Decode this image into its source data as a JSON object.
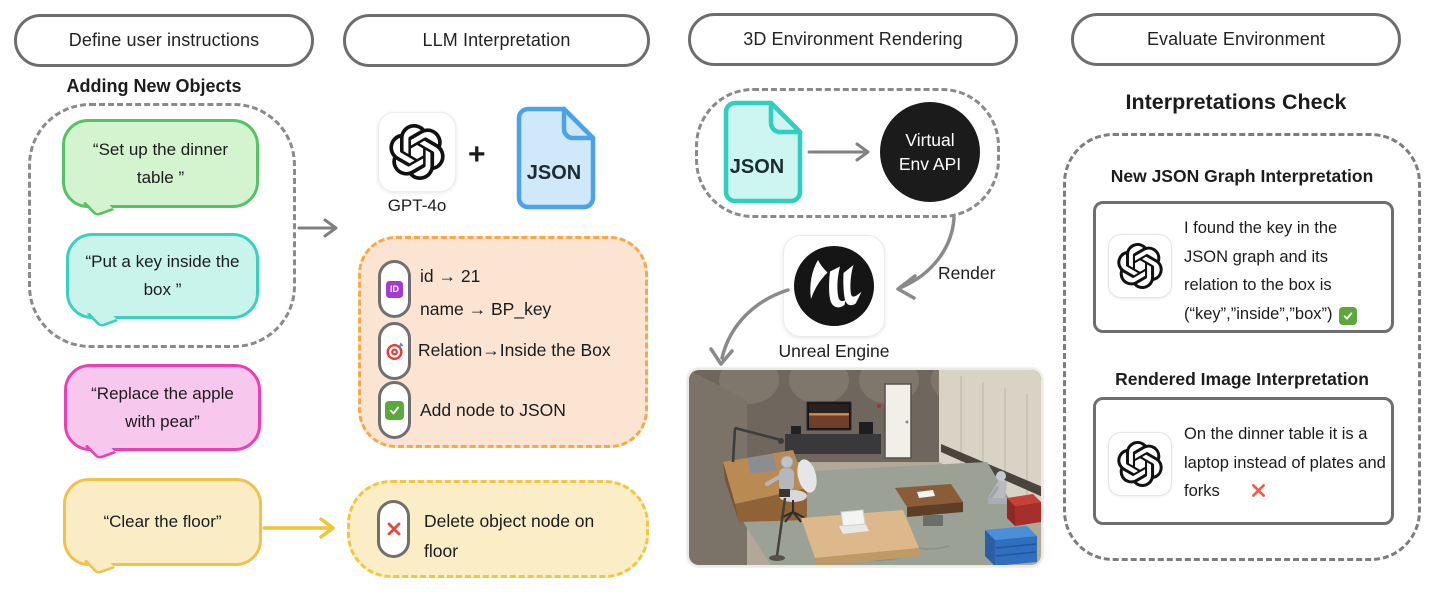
{
  "headers": {
    "col1": "Define user instructions",
    "col2": "LLM Interpretation",
    "col3": "3D Environment Rendering",
    "col4": "Evaluate Environment"
  },
  "instructions": {
    "group_title": "Adding New Objects",
    "bubble_green": "“Set up the dinner table ”",
    "bubble_teal": "“Put a key inside the box ”",
    "bubble_pink": "“Replace the apple with pear”",
    "bubble_yellow": "“Clear the floor”"
  },
  "llm": {
    "model_label": "GPT-4o",
    "plus": "+",
    "json_label": "JSON",
    "add_panel": {
      "id_line": "id → 21",
      "name_line": "name → BP_key",
      "relation_line": "Relation→Inside the Box",
      "add_line": "Add node to JSON"
    },
    "delete_panel": {
      "delete_line": "Delete object node on floor"
    }
  },
  "rendering": {
    "json_label": "JSON",
    "api_line1": "Virtual",
    "api_line2": "Env API",
    "render_label": "Render",
    "engine_label": "Unreal Engine"
  },
  "evaluate": {
    "title": "Interpretations Check",
    "json_check": {
      "heading": "New JSON Graph Interpretation",
      "text": "I found the key in the JSON graph and its relation to the box is (“key”,”inside”,”box”)"
    },
    "image_check": {
      "heading": "Rendered Image Interpretation",
      "text": "On the dinner table it is a laptop instead of plates and forks"
    }
  },
  "icons": {
    "id_badge_label": "ID",
    "openai_logo": "openai-logo",
    "json_file_blue": "json-file-icon-blue",
    "json_file_teal": "json-file-icon-teal",
    "target_icon": "target-icon",
    "check_icon": "check-icon",
    "cross_icon": "cross-icon",
    "unreal_logo": "unreal-engine-logo"
  },
  "colors": {
    "bubble_green_fill": "#d4f3cf",
    "bubble_green_stroke": "#55c263",
    "bubble_teal_fill": "#c9f4ec",
    "bubble_teal_stroke": "#3bcfc0",
    "bubble_pink_fill": "#f8c7ee",
    "bubble_pink_stroke": "#ec3fb4",
    "bubble_gold_fill": "#faecc5",
    "bubble_gold_stroke": "#f0c24a",
    "panel_orange_fill": "#fbe5d2",
    "panel_orange_stroke": "#f6a945",
    "panel_yellow_fill": "#fbeec6",
    "panel_yellow_stroke": "#f2c63e",
    "json_blue_fill": "#cfe9fb",
    "json_blue_stroke": "#4aa3e8",
    "json_teal_fill": "#ccf6ef",
    "json_teal_stroke": "#2ecfc0",
    "dash_gray": "#8a8a8a",
    "arrow_gray": "#808080",
    "arrow_yellow": "#f2c436",
    "check_green": "#5ba83c",
    "cross_red": "#ef4a3f",
    "api_circle": "#1b1b1b"
  }
}
